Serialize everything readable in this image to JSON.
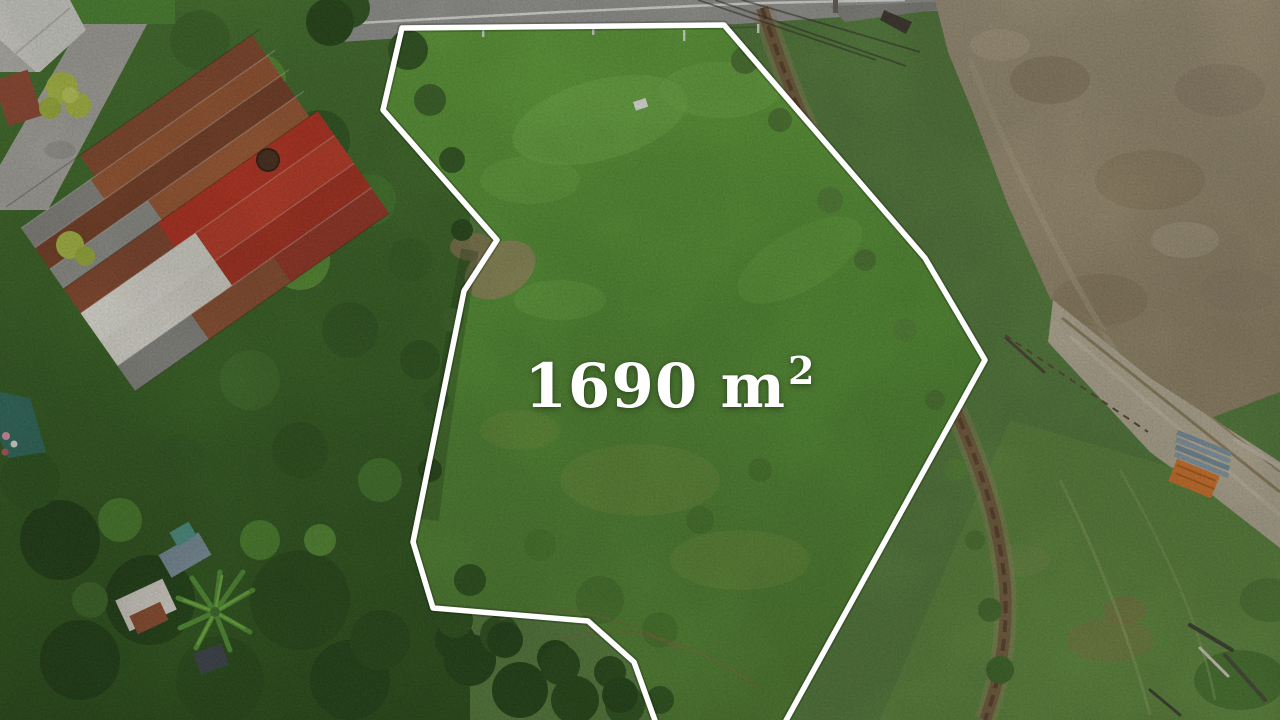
{
  "photo": {
    "kind": "aerial-drone-photo-of-land-plot",
    "overlay": {
      "area_value": "1690 m",
      "area_exponent": "2",
      "area_label_full": "1690 m²",
      "boundary_color": "#ffffff",
      "label_color": "#ffffff"
    },
    "scene_colors": {
      "plot_grass": "#559230",
      "tree_canopy": "#2e5a1d",
      "dry_field": "#a59878",
      "dirt_road": "#c0b69c",
      "paved_road": "#a2a29e",
      "pasture": "#5e8b3b",
      "red_roof": "#c5311d",
      "rust_roof": "#8d4a2a",
      "white_roof": "#efede2"
    }
  }
}
